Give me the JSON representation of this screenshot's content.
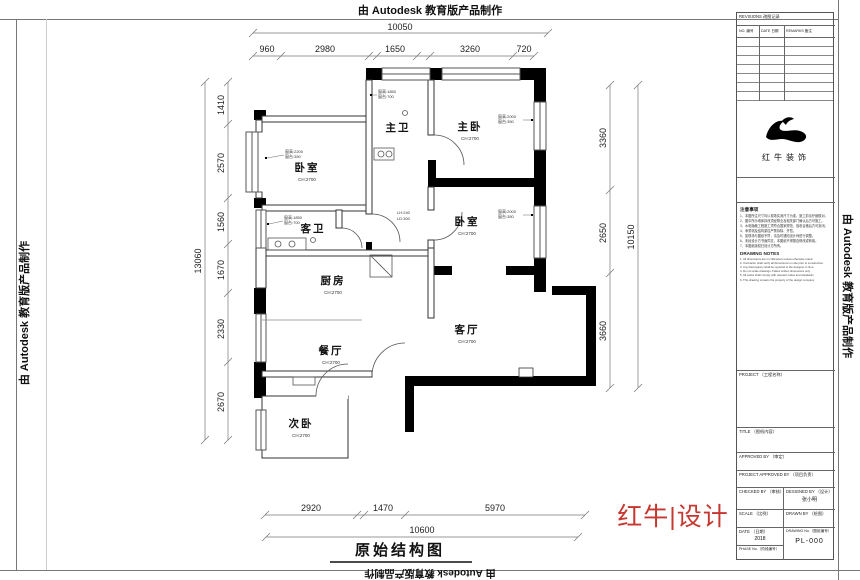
{
  "banner": {
    "autodesk_text": "由 Autodesk 教育版产品制作"
  },
  "plan": {
    "title": "原始结构图",
    "rooms": {
      "master_bath": "主卫",
      "master_bedroom": "主卧",
      "bedroom_left": "卧室",
      "bedroom_right": "卧室",
      "guest_bath": "客卫",
      "kitchen": "厨房",
      "living_room": "客厅",
      "dining_room": "餐厅",
      "second_bedroom": "次卧",
      "ceiling_height": "CH:2700"
    },
    "window_notes": {
      "master_bath": [
        "窗高:1850",
        "窗台:700"
      ],
      "bedroom_left": [
        "窗高:2200",
        "窗台:350"
      ],
      "guest_bath": [
        "窗高:1850",
        "窗台:700"
      ],
      "master_bedroom": [
        "窗高:2000",
        "窗台:350"
      ],
      "bedroom_right": [
        "窗高:2000",
        "窗台:350"
      ],
      "beam": [
        "LH:240",
        "LD:300"
      ]
    },
    "dimensions": {
      "top": {
        "overall": "10050",
        "segments": [
          "960",
          "2980",
          "1650",
          "3260",
          "720"
        ]
      },
      "left": {
        "overall": "13060",
        "segments": [
          "1410",
          "2570",
          "1560",
          "1670",
          "2330",
          "2670"
        ]
      },
      "right": {
        "overall": "10150",
        "segments": [
          "3360",
          "2650",
          "3660"
        ]
      },
      "bottom": {
        "overall": "10600",
        "segments": [
          "2920",
          "1470",
          "5970"
        ]
      }
    }
  },
  "title_block": {
    "revisions": {
      "header": "REVISIONS 改图记录",
      "col_no": "NO. 编号",
      "col_date": "DATE 日期",
      "col_remarks": "REMARKS 备注"
    },
    "logo": {
      "company": "红牛装饰"
    },
    "notes_cn": {
      "header": "注意事项",
      "items": [
        "1、本图所注尺寸均以现场实测尺寸为准，施工前请仔细核对。",
        "2、图中所示墙体拆改须经物业及相关部门确认后方可施工。",
        "3、水电隐蔽工程施工须符合国家规范，验收合格后方可封闭。",
        "4、承重墙及结构梁柱严禁拆除、开凿。",
        "5、如现场与图纸不符，请及时通知设计师进行调整。",
        "6、未经设计方书面同意，本图纸不得擅自修改或转用。",
        "7、本图纸版权归设计方所有。"
      ]
    },
    "notes_en": {
      "header": "DRAWING NOTES",
      "items": [
        "1. All dimensions are in millimeters unless otherwise noted.",
        "2. Contractor shall verify all dimensions on site prior to construction.",
        "3. Any discrepancy shall be reported to the designer in time.",
        "4. Do not scale drawings. Follow written dimensions only.",
        "5. All works shall comply with relevant codes and standards.",
        "6. This drawing remains the property of the design company."
      ]
    },
    "project_label": "PROJECT （工程名称）",
    "title_label": "TITLE （图纸内容）",
    "approved_label": "APPROVED BY （审定）",
    "project_approved_label": "PROJECT APPROVED BY （项目负责）",
    "checked_label": "CHECKED BY （审核）",
    "designed_label": "DESIGNED BY （设计）",
    "designed_value": "张小明",
    "scale_label": "SCALE （比例）",
    "drawn_label": "DRAWN BY （绘图）",
    "date_label": "DATE （日期）",
    "date_value": "2018",
    "phase_label": "PHASE No.（阶段编号）",
    "drawing_no_label": "DRAWING No.（图纸编号）",
    "drawing_no_value": "PL-000"
  },
  "brand": {
    "red_logo": "红牛|设计"
  }
}
